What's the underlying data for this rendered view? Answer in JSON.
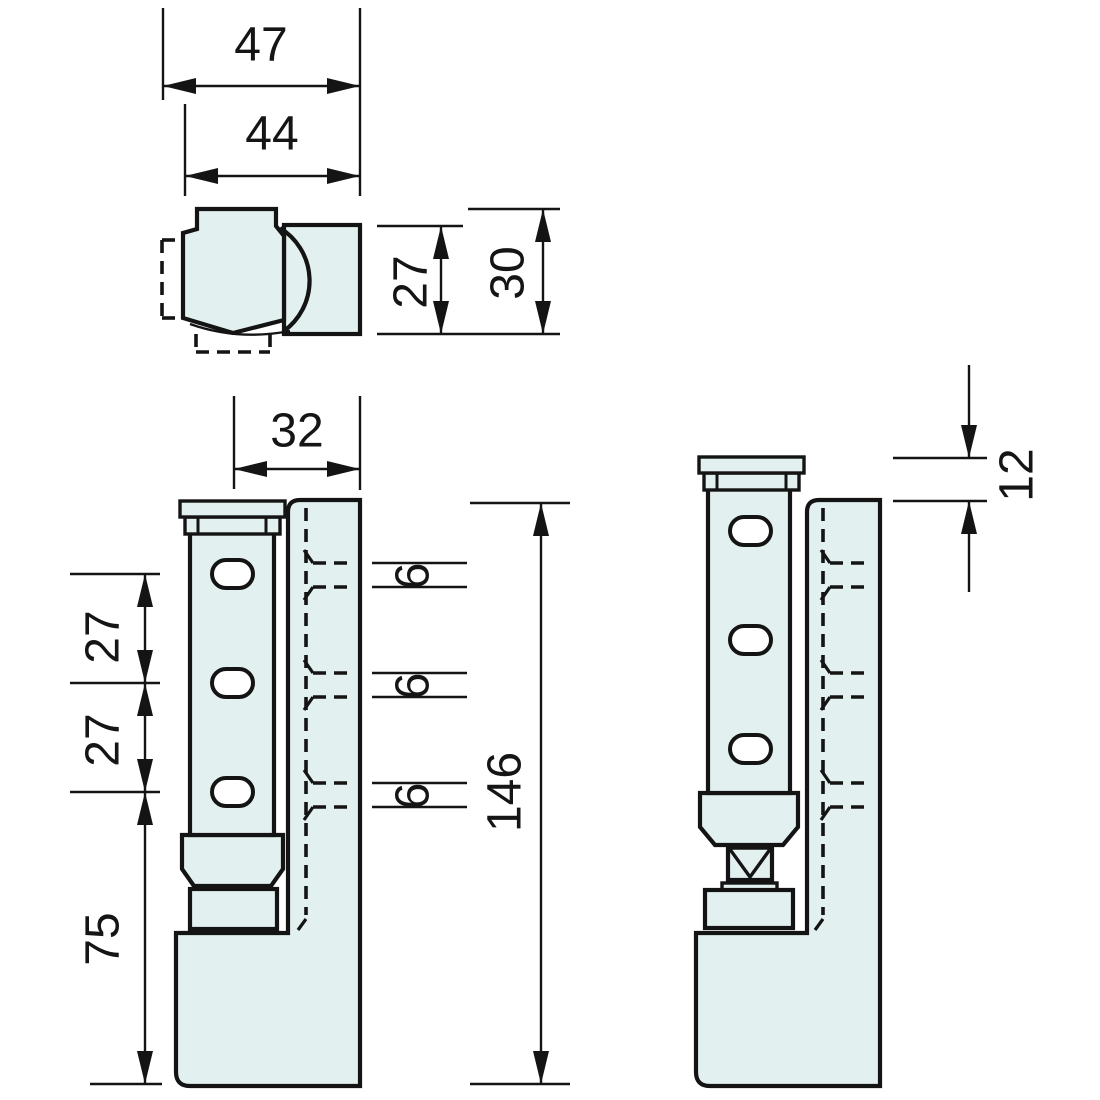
{
  "drawing": {
    "type": "technical-drawing",
    "subject": "lift-off hinge with frame profile, three orthographic views",
    "colors": {
      "background": "#ffffff",
      "part_fill": "#e2f1ef",
      "line": "#141414"
    }
  },
  "views": {
    "top": {
      "dims": {
        "overall_width": "47",
        "leaf_width": "44",
        "frame_depth": "27",
        "overall_depth": "30"
      }
    },
    "front_closed": {
      "dims": {
        "axis_to_frame_edge": "32",
        "hole_spacing_upper": "27",
        "hole_spacing_lower": "27",
        "lower_section_height": "75",
        "overall_height": "146",
        "slot_heights": [
          "6",
          "6",
          "6"
        ]
      }
    },
    "front_lifted": {
      "dims": {
        "lift_travel": "12"
      }
    }
  }
}
